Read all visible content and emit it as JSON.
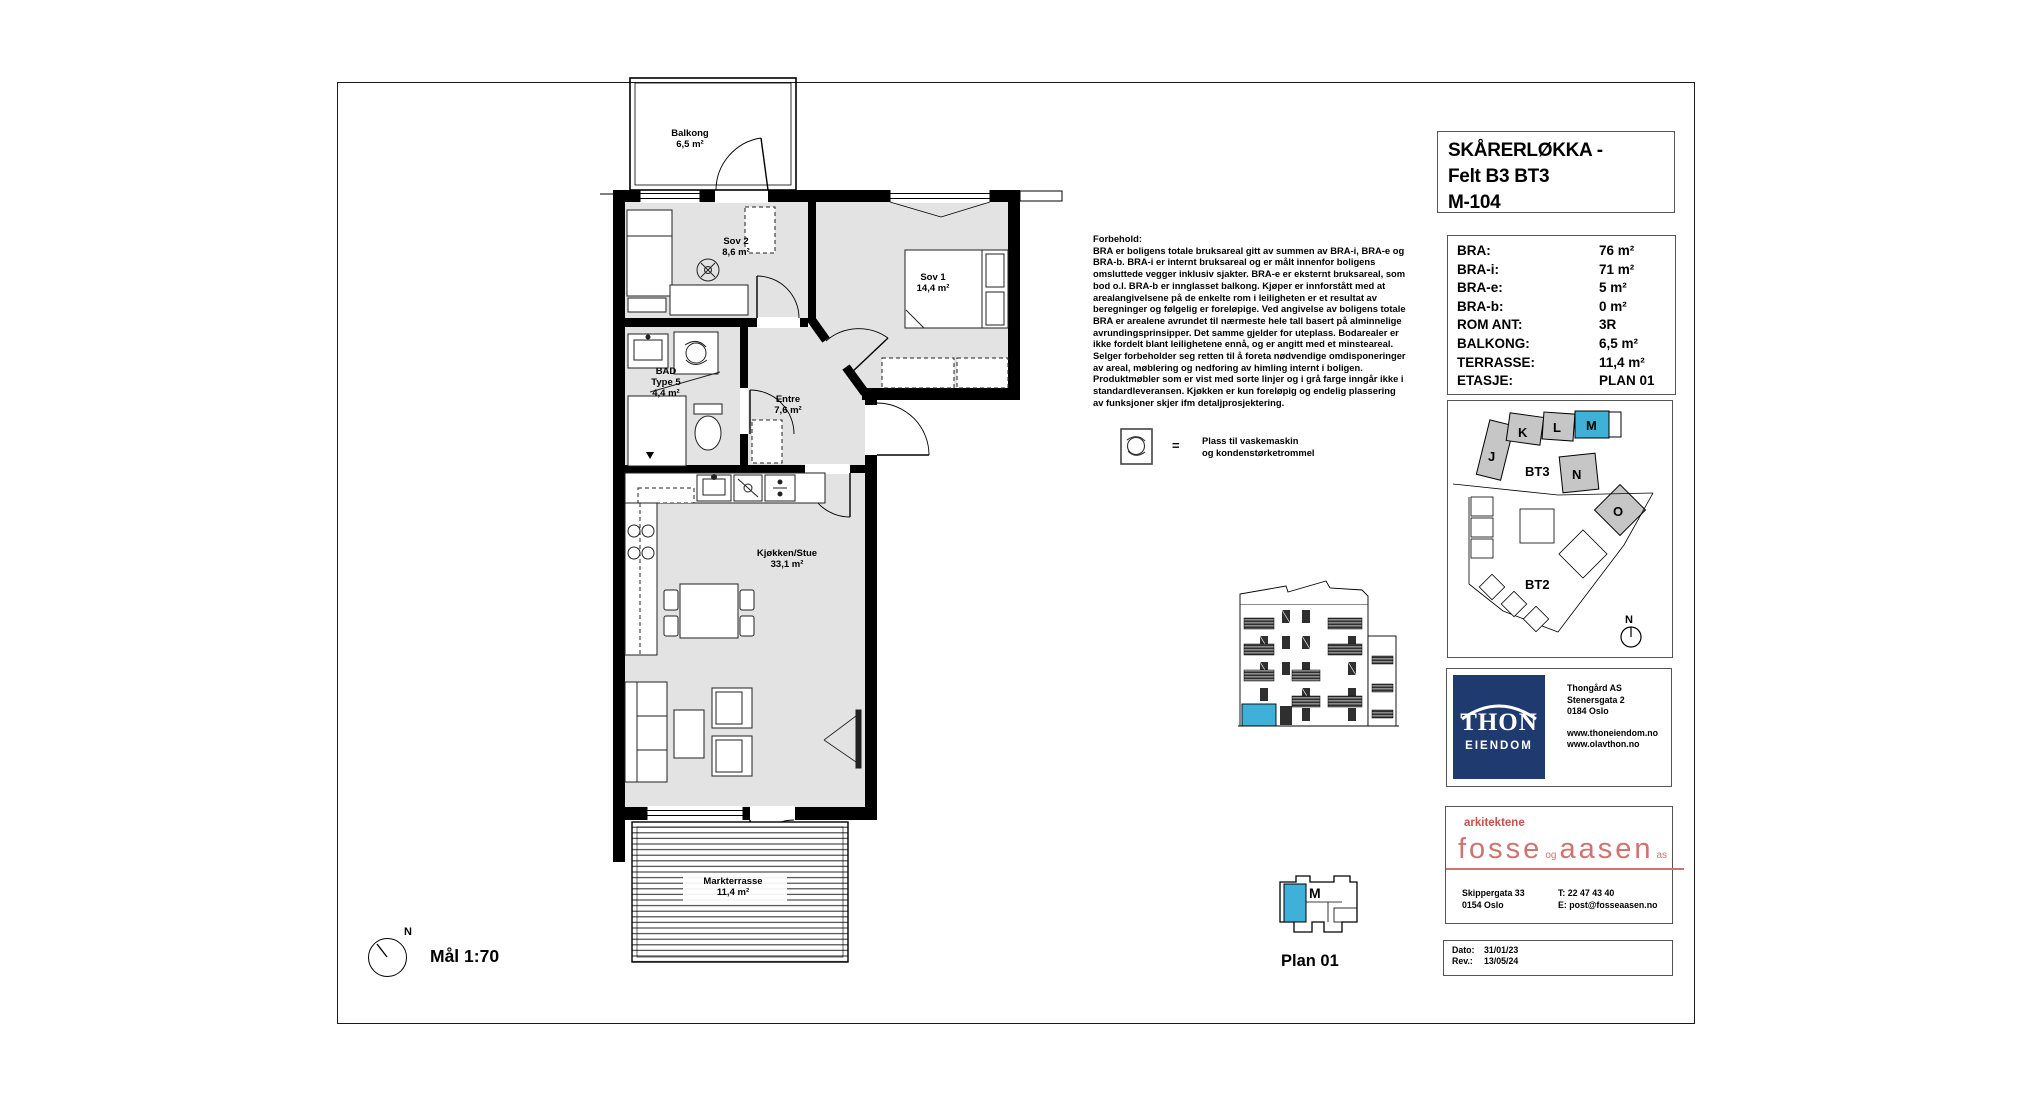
{
  "title_block": {
    "line1": "SKÅRERLØKKA -",
    "line2": "Felt B3 BT3",
    "line3": "M-104"
  },
  "info_panel": {
    "rows": [
      {
        "label": "BRA:",
        "value": "76 m²"
      },
      {
        "label": "BRA-i:",
        "value": "71 m²"
      },
      {
        "label": "BRA-e:",
        "value": "5 m²"
      },
      {
        "label": "BRA-b:",
        "value": "0 m²"
      },
      {
        "label": "ROM ANT:",
        "value": "3R"
      },
      {
        "label": "BALKONG:",
        "value": "6,5 m²"
      },
      {
        "label": "TERRASSE:",
        "value": "11,4 m²"
      },
      {
        "label": "ETASJE:",
        "value": "PLAN 01"
      }
    ]
  },
  "disclaimer": {
    "heading": "Forbehold:",
    "body": "BRA er boligens totale bruksareal gitt av summen av BRA-i, BRA-e og BRA-b. BRA-i er internt bruksareal og er målt innenfor boligens omsluttede vegger inklusiv sjakter. BRA-e er eksternt bruksareal, som bod o.l. BRA-b er innglasset balkong. Kjøper er innforstått med at arealangivelsene på de enkelte rom i leiligheten er et resultat av beregninger og følgelig er foreløpige. Ved angivelse av boligens totale BRA er arealene avrundet til nærmeste hele tall basert på alminnelige avrundingsprinsipper. Det samme gjelder for uteplass. Bodarealer er ikke fordelt blant leilighetene ennå, og er angitt med et minsteareal. Selger forbeholder seg retten til å foreta nødvendige omdisponeringer av areal, møblering og nedforing av himling internt i boligen. Produktmøbler som er vist med sorte linjer og i grå farge inngår ikke i standardleveransen. Kjøkken er kun foreløpig og endelig plassering av funksjoner skjer ifm detaljprosjektering."
  },
  "legend": {
    "equals": "=",
    "line1": "Plass til vaskemaskin",
    "line2": "og kondenstørketrommel"
  },
  "rooms": {
    "balkong": {
      "name": "Balkong",
      "area": "6,5 m²"
    },
    "sov2": {
      "name": "Sov 2",
      "area": "8,6 m²"
    },
    "sov1": {
      "name": "Sov 1",
      "area": "14,4 m²"
    },
    "bad": {
      "line1": "BAD",
      "line2": "Type 5",
      "area": "4,4 m²"
    },
    "entre": {
      "name": "Entre",
      "area": "7,6 m²"
    },
    "kjokken_stue": {
      "name": "Kjøkken/Stue",
      "area": "33,1 m²"
    },
    "markterrasse": {
      "name": "Markterrasse",
      "area": "11,4 m²"
    }
  },
  "plan_footer": {
    "north": "N",
    "scale": "Mål 1:70"
  },
  "site_plan": {
    "j": "J",
    "k": "K",
    "l": "L",
    "m": "M",
    "n": "N",
    "o": "O",
    "bt3": "BT3",
    "bt2": "BT2",
    "north": "N"
  },
  "key_plan": {
    "unit": "M",
    "caption": "Plan 01"
  },
  "developer": {
    "logo_top": "THON",
    "logo_bottom": "EIENDOM",
    "company": "Thongård AS",
    "street": "Stenersgata 2",
    "city": "0184 Oslo",
    "web1": "www.thoneiendom.no",
    "web2": "www.olavthon.no"
  },
  "architect": {
    "tagline": "arkitektene",
    "fosse": "fosse",
    "og": "og",
    "aasen": "aasen",
    "as": "as",
    "street": "Skippergata 33",
    "city": "0154 Oslo",
    "phone": "T: 22 47 43 40",
    "email": "E: post@fosseaasen.no"
  },
  "revision": {
    "rows": [
      {
        "label": "Dato:",
        "value": "31/01/23"
      },
      {
        "label": "Rev.:",
        "value": "13/05/24"
      }
    ]
  },
  "colors": {
    "highlight": "#3fb1d8",
    "navy": "#1e3a6e",
    "red": "#c9504c",
    "room_gray": "#e3e3e3"
  }
}
